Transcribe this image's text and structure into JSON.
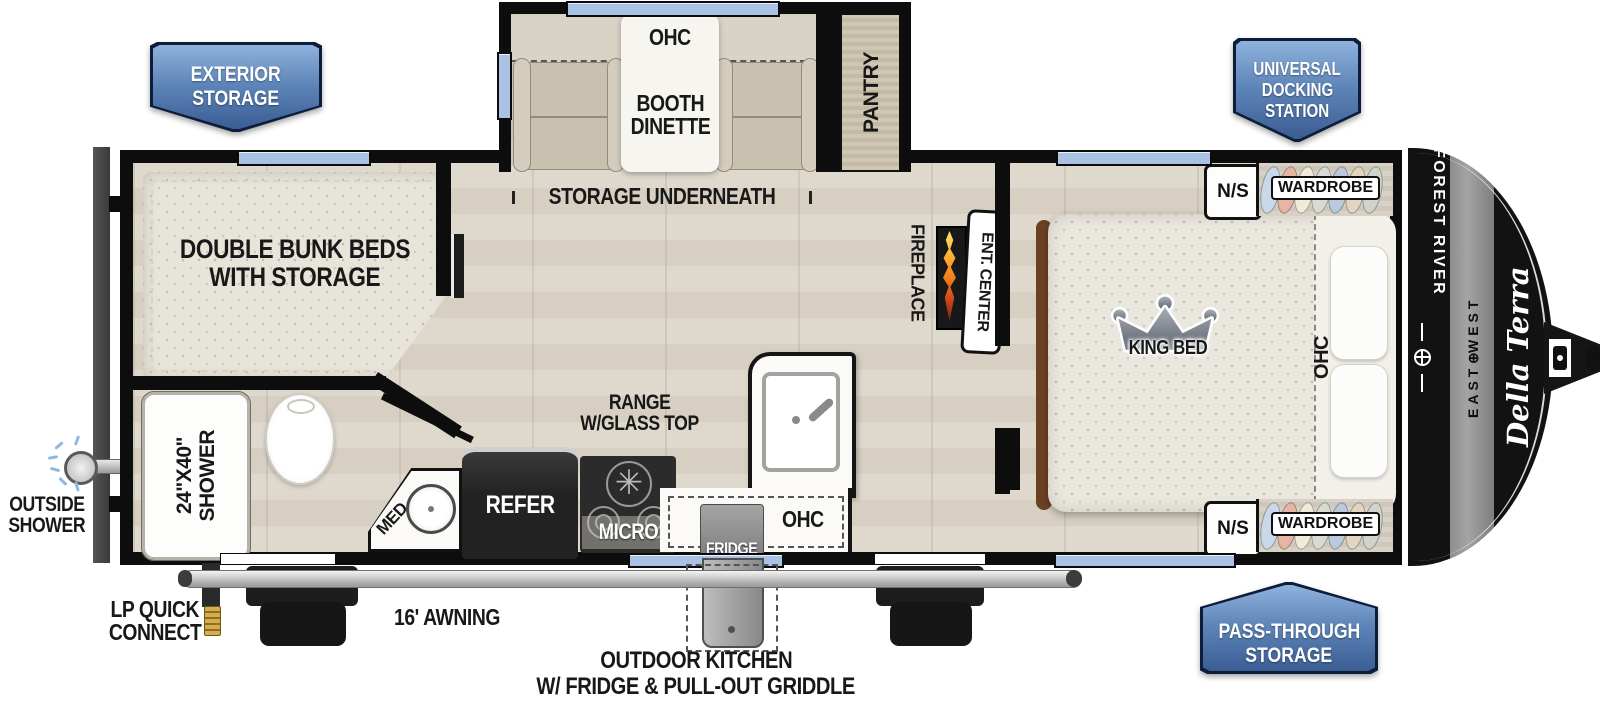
{
  "badges": {
    "exterior_storage": [
      "EXTERIOR",
      "STORAGE"
    ],
    "universal_docking": [
      "UNIVERSAL",
      "DOCKING",
      "STATION"
    ],
    "pass_through": [
      "PASS-THROUGH",
      "STORAGE"
    ]
  },
  "slideout": {
    "ohc": "OHC",
    "booth": [
      "BOOTH",
      "DINETTE"
    ],
    "pantry": "PANTRY",
    "storage_underneath": "STORAGE UNDERNEATH"
  },
  "bunk": {
    "line1": "DOUBLE BUNK BEDS",
    "line2": "WITH STORAGE"
  },
  "bath": {
    "shower_size": "24\"x40\"",
    "shower": "SHOWER",
    "med": "MED",
    "outside1": "OUTSIDE",
    "outside2": "SHOWER"
  },
  "kitchen": {
    "refer": "REFER",
    "micro": "MICRO",
    "range1": "RANGE",
    "range2": "W/GLASS TOP",
    "ohc": "OHC",
    "fridge": "FRIDGE"
  },
  "living": {
    "fireplace": "FIREPLACE",
    "ent_center": "ENT. CENTER"
  },
  "bedroom": {
    "king": "KING BED",
    "ohc": "OHC",
    "ns_top": "N/S",
    "wardrobe_top": "WARDROBE",
    "ns_bottom": "N/S",
    "wardrobe_bottom": "WARDROBE"
  },
  "exterior": {
    "lp1": "LP QUICK",
    "lp2": "CONNECT",
    "awning": "16' AWNING",
    "outdoor1": "OUTDOOR KITCHEN",
    "outdoor2": "W/ FRIDGE & PULL-OUT GRIDDLE"
  },
  "brand": {
    "forest_river": "FOREST RIVER",
    "east": "EAST",
    "compass": "⊕",
    "west": "WEST",
    "model": "Della Terra"
  },
  "colors": {
    "badge_top": "#8fb2dc",
    "badge_bottom": "#3a5d93",
    "window_blue": "#a9c2e3",
    "wall_black": "#0d0d0d",
    "flame_orange": "#f07818",
    "floor_wood": "#d9d2c6",
    "mattress": "#eae7df"
  }
}
